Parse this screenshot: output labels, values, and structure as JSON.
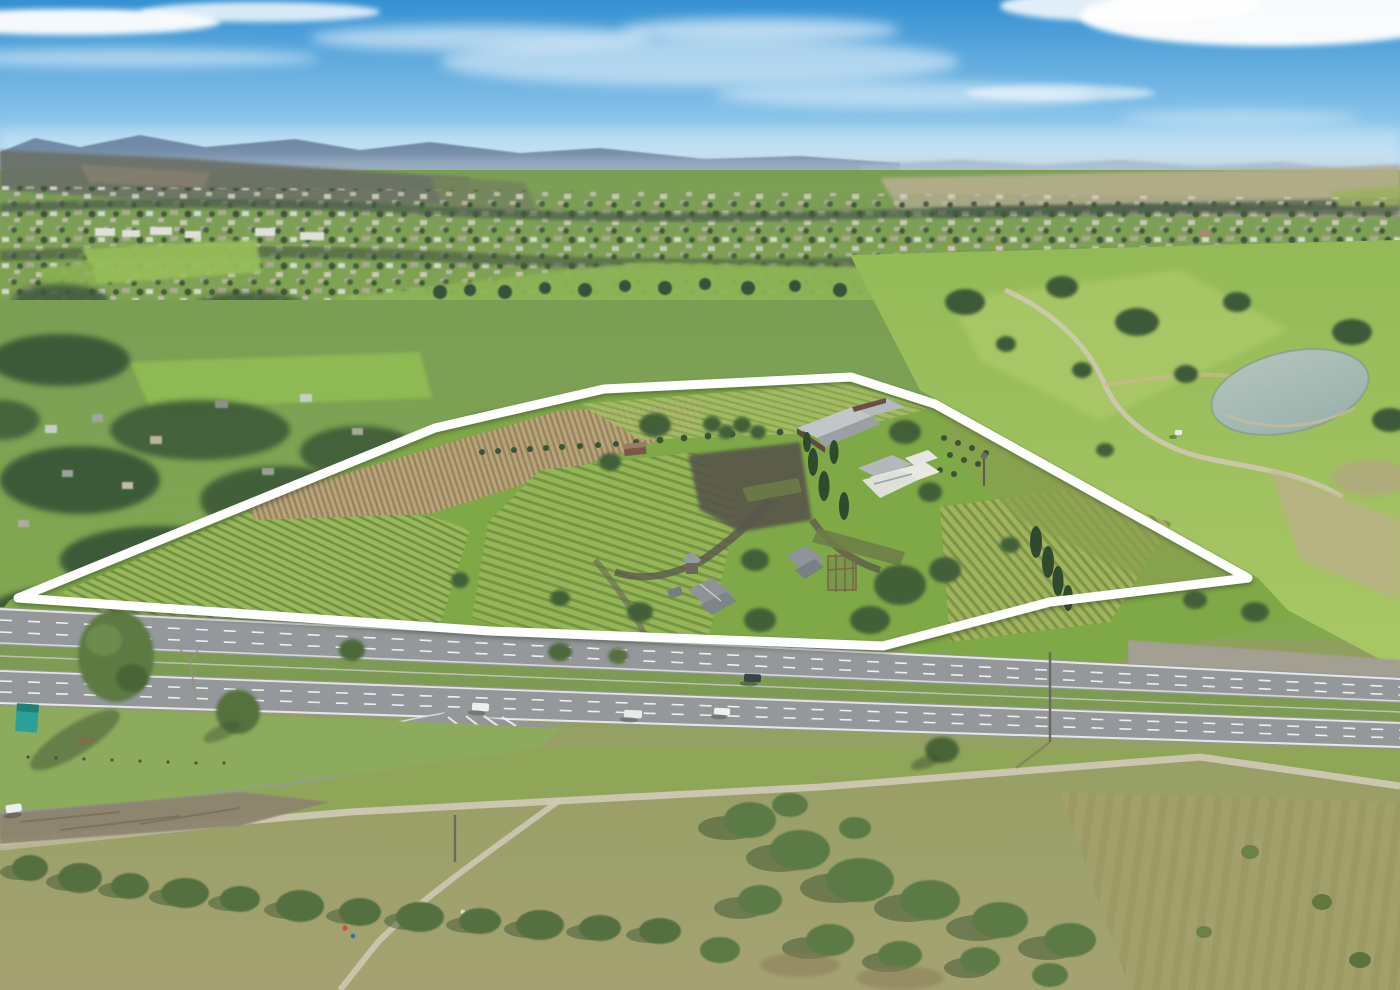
{
  "scene": {
    "type": "aerial-photograph",
    "subject": "rural vineyard property outlined in white beside a highway, town and golf course beyond"
  },
  "boundary": {
    "points": "18,598 435,428 604,389 851,377 935,404 1248,578 1050,602 883,646 490,631",
    "color": "#ffffff",
    "stroke_width": 9
  },
  "palette": {
    "sky_top": "#3590d2",
    "sky_horizon": "#d7ecf7",
    "cloud": "#ffffff",
    "mountain_far": "#69829f",
    "haze": "#b9cad7",
    "ridge_dark": "#67705f",
    "plains": "#b5ae8d",
    "town_green": "#7d9a66",
    "golf_green": "#8cb354",
    "field_green": "#7fa847",
    "vine_row_light": "#9cb85c",
    "vine_row_dark": "#6e9140",
    "tilled_light": "#b9a47b",
    "tilled_dark": "#9a8260",
    "tree_dark": "#3f5e3c",
    "scrub_green": "#55703f",
    "grass_khaki": "#a19e6b",
    "pond_water": "#9db4ae",
    "asphalt": "#95989b",
    "median_grass": "#7d9b52",
    "path_sand": "#cfc8b4",
    "gravel": "#8d8470",
    "roof_gray": "#b4b8ba",
    "house_white": "#e9e9e4",
    "brick_dark": "#5f4a40",
    "car_white": "#eceff0",
    "car_dark": "#3a4448",
    "dumpster_teal": "#2aa198"
  }
}
